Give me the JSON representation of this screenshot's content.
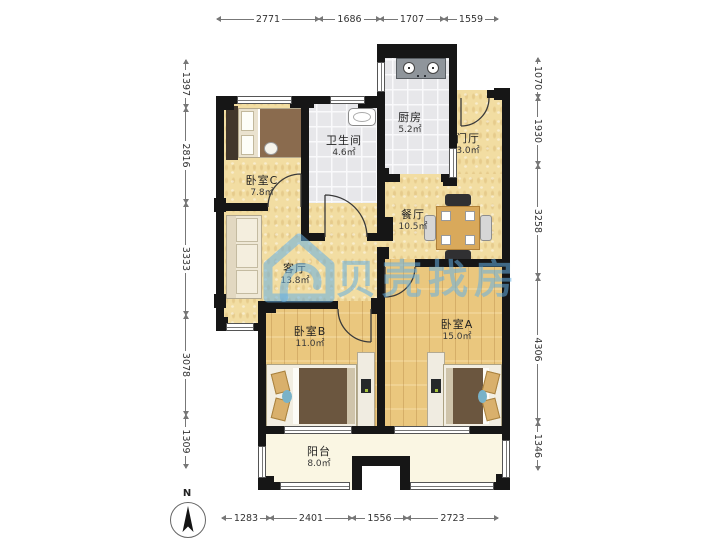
{
  "watermark": {
    "brand": "贝壳找房",
    "color": "#64afe2"
  },
  "compass": {
    "label": "N"
  },
  "rooms": {
    "kitchen": {
      "name": "厨房",
      "area": "5.2㎡"
    },
    "hall": {
      "name": "门厅",
      "area": "3.0㎡"
    },
    "bathroom": {
      "name": "卫生间",
      "area": "4.6㎡"
    },
    "bedroomC": {
      "name": "卧室C",
      "area": "7.8㎡"
    },
    "dining": {
      "name": "餐厅",
      "area": "10.5㎡"
    },
    "living": {
      "name": "客厅",
      "area": "13.8㎡"
    },
    "bedroomB": {
      "name": "卧室B",
      "area": "11.0㎡"
    },
    "bedroomA": {
      "name": "卧室A",
      "area": "15.0㎡"
    },
    "balcony": {
      "name": "阳台",
      "area": "8.0㎡"
    }
  },
  "dimensions": {
    "top": [
      "2771",
      "1686",
      "1707",
      "1559"
    ],
    "bottom": [
      "1283",
      "2401",
      "1556",
      "2723"
    ],
    "left": [
      "1397",
      "2816",
      "3333",
      "3078",
      "1309"
    ],
    "right": [
      "1070",
      "1930",
      "3258",
      "4306",
      "1346"
    ]
  }
}
